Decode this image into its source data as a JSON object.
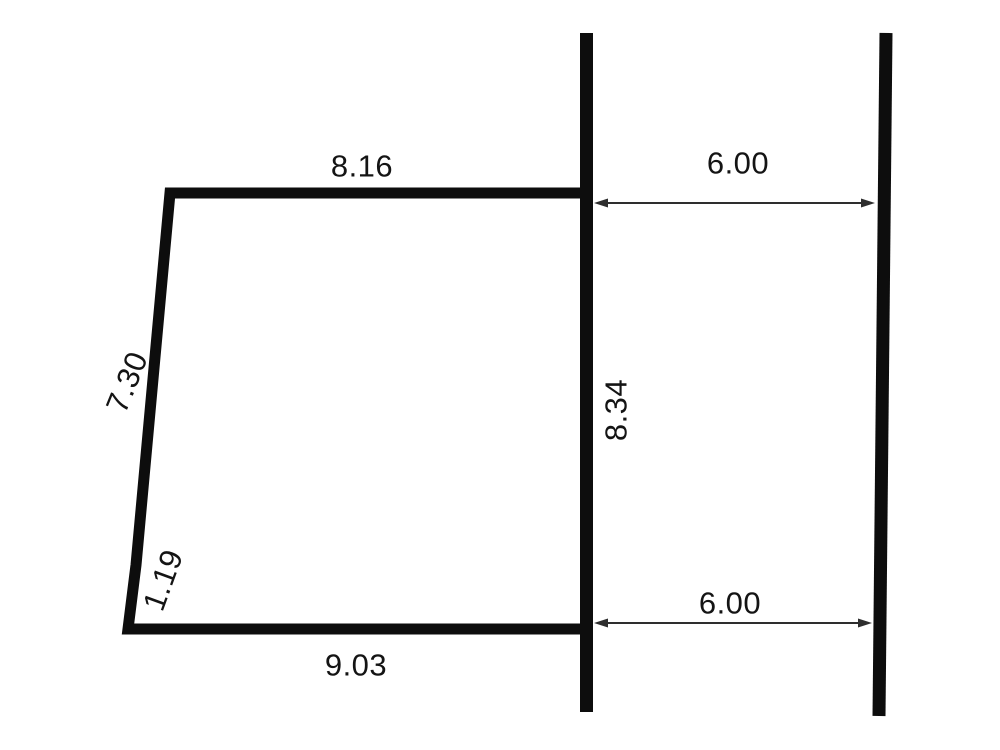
{
  "figure": {
    "kind": "dimensioned-survey-diagram",
    "labels": {
      "top_edge": "8.16",
      "left_edge_upper": "7.30",
      "left_edge_lower": "1.19",
      "bottom_edge": "9.03",
      "center_line": "8.34",
      "top_gap": "6.00",
      "bottom_gap": "6.00"
    },
    "colors": {
      "ink": "#0d0d0d",
      "arrow": "#2e2e2e",
      "text": "#141414",
      "background": "#ffffff"
    }
  }
}
